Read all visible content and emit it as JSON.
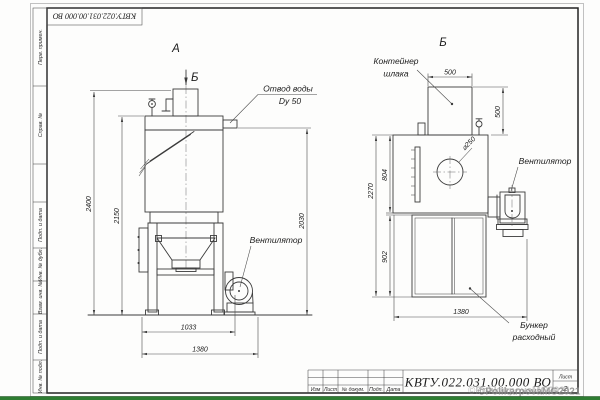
{
  "sheet": {
    "top_designation": "КВТУ.022.031.00.000  ВО",
    "watermark": "©PolikarpovaMG2021"
  },
  "sidebar": {
    "items": [
      "Перв. примен.",
      "Справ. №",
      "Подп. и дата",
      "Инв. № дубл.",
      "Взам. инв. №",
      "Подп. и дата",
      "Инв. № подл."
    ]
  },
  "left_view": {
    "title": "А",
    "section_label": "Б",
    "water_outlet_line1": "Отвод воды",
    "water_outlet_line2": "Dy 50",
    "fan_label": "Вентилятор",
    "dim_height_total": "2400",
    "dim_height_body": "2150",
    "dim_height_outlet": "2030",
    "dim_width_inner": "1033",
    "dim_width_total": "1380"
  },
  "right_view": {
    "title": "Б",
    "container_label_line1": "Контейнер",
    "container_label_line2": "шлака",
    "fan_label": "Вентилятор",
    "bunker_label_line1": "Бункер",
    "bunker_label_line2": "расходный",
    "dim_width_container": "500",
    "dim_height_container": "500",
    "dim_diameter": "⌀250",
    "dim_height_upper": "804",
    "dim_height_total": "2270",
    "dim_height_bunker": "902",
    "dim_width_total": "1380"
  },
  "title_block": {
    "columns": [
      "Изм",
      "Лист",
      "№ докум.",
      "Подп.",
      "Дата"
    ],
    "designation": "КВТУ.022.031.00.000  ВО",
    "sheet_label": "Лист",
    "sheet_number": "2"
  }
}
